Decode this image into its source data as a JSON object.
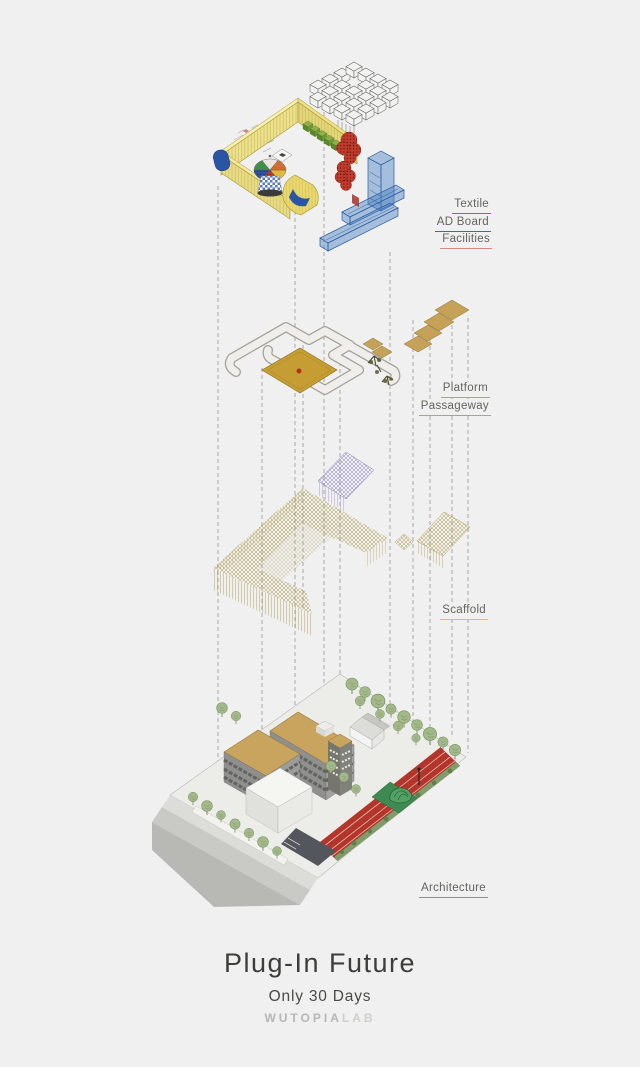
{
  "poster": {
    "title": "Plug-In Future",
    "subtitle": "Only 30 Days",
    "logo": {
      "primary": "WUTOPIA",
      "secondary": "LAB"
    }
  },
  "annotations": {
    "textile": {
      "text": "Textile",
      "underline": "#bf5a4e"
    },
    "ad_board": {
      "text": "AD Board",
      "underline": "#3a6ab2"
    },
    "facilities": {
      "text": "Facilities",
      "underline": "#d6897f"
    },
    "platform": {
      "text": "Platform",
      "underline": "#a2a792"
    },
    "passageway": {
      "text": "Passageway",
      "underline": "#a2a792"
    },
    "scaffold": {
      "text": "Scaffold",
      "underline": "#e3c838"
    },
    "architecture": {
      "text": "Architecture",
      "underline": "#8f8f8b"
    }
  },
  "diagram": {
    "type": "exploded-axonometric",
    "layers": [
      {
        "name": "facilities-layer",
        "labels": [
          "Textile",
          "AD Board",
          "Facilities"
        ]
      },
      {
        "name": "platform-layer",
        "labels": [
          "Platform",
          "Passageway"
        ]
      },
      {
        "name": "scaffold-layer",
        "labels": [
          "Scaffold"
        ]
      },
      {
        "name": "architecture-layer",
        "labels": [
          "Architecture"
        ]
      }
    ],
    "palette": {
      "background": "#f0f0f0",
      "textile_yellow": "#eee28e",
      "panel_blue": "#2a55a5",
      "hedge_green": "#8fae4a",
      "tree_red": "#c33b2c",
      "adboard_blue": "#4a80c2",
      "passage_gray": "#efeeea",
      "platform_gold": "#c79e33",
      "stair_tan": "#c5a258",
      "scaffold_olive": "#a5913c",
      "scaffold_purple": "#8d7fc0",
      "site_gray": "#ecece9",
      "roof_tan": "#c9a45e",
      "track_red": "#b5372c",
      "court_green": "#3f8a52",
      "tree_green": "#a3b88b"
    }
  }
}
